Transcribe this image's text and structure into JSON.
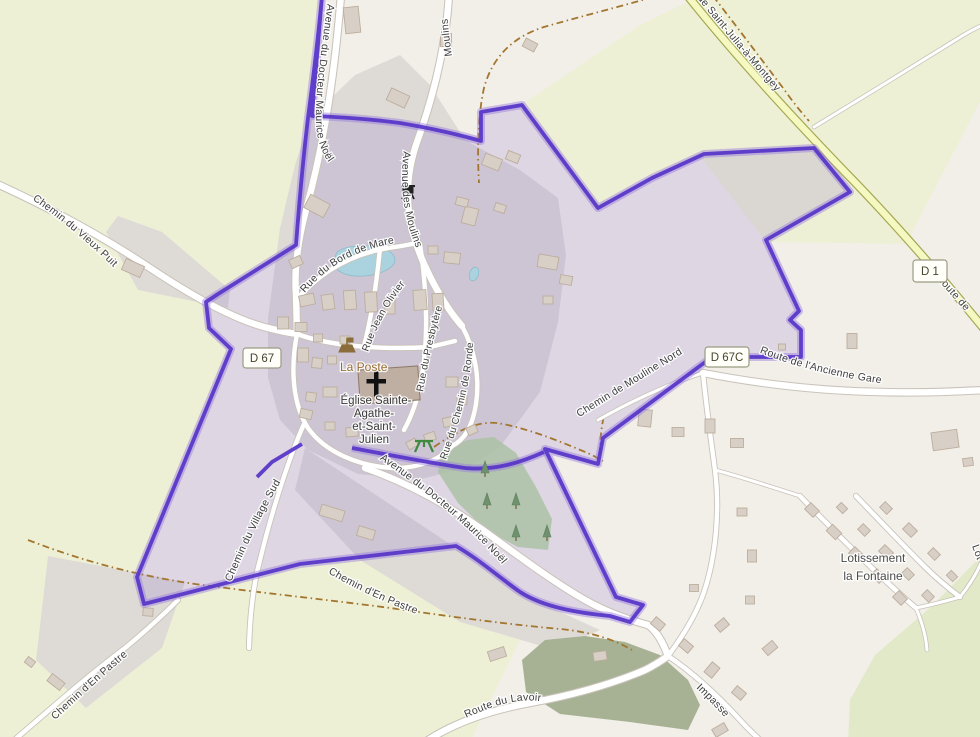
{
  "colors": {
    "boundary": "#5838c8",
    "boundary_glow": "rgba(150,122,221,0.45)",
    "boundary_fill": "rgba(118,84,196,0.16)",
    "water": "#aad3df",
    "farmland": "#eef0d5",
    "residential": "#dedbd6",
    "forest": "#a9c1a1",
    "green_area": "#a7b294",
    "scrub": "#e2e9c8",
    "road_fill": "#ffffff",
    "road_casing": "#c9c3ba",
    "d_road_fill": "#f5f8c0",
    "d_road_casing": "#a6a857",
    "track": "#a3762f",
    "building": "#d8cfc7",
    "building_outline": "#bcae9e",
    "label": "#3e3e3e",
    "poi_label": "#996c33",
    "badge_border": "#9b9b83"
  },
  "labels": {
    "streets": {
      "avenue_docteur_maurice_noel": "Avenue du Docteur Maurice Noël",
      "avenue_docteur_maurice_noel_2": "Avenue du Docteur Maurice Noël",
      "moulins_top": "Moulins",
      "avenue_des_moulins": "Avenue des Moulins",
      "rue_du_bord_de_mare": "Rue du Bord de Mare",
      "rue_jean_olivier": "Rue Jean Olivier",
      "rue_du_presbytere": "Rue du Presbytère",
      "rue_du_chemin_de_ronde": "Rue du Chemin de Ronde",
      "chemin_du_vieux_puit": "Chemin du Vieux Puit",
      "de_saint_julia_a_montgey": "de Saint-Julia-à-Montgey",
      "route_de_partial": "Route de",
      "route_de_l_ancienne_gare": "Route de l'Ancienne Gare",
      "chemin_de_mouline_nord": "Chemin de Mouline Nord",
      "chemin_du_village_sud": "Chemin du Village Sud",
      "chemin_d_en_pastre_track": "Chemin d'En Pastre",
      "chemin_d_en_pastre_road": "Chemin d'En Pastre",
      "route_du_lavoir": "Route du Lavoir",
      "impasse": "Impasse",
      "lot_partial": "Lot"
    },
    "badges": {
      "d67": "D 67",
      "d67c": "D 67C",
      "d1": "D 1"
    },
    "places": {
      "la_poste": "La Poste",
      "eglise_line1": "Église Sainte-",
      "eglise_line2": "Agathe-",
      "eglise_line3": "et-Saint-",
      "eglise_line4": "Julien",
      "lotissement_line1": "Lotissement",
      "lotissement_line2": "la Fontaine"
    }
  }
}
